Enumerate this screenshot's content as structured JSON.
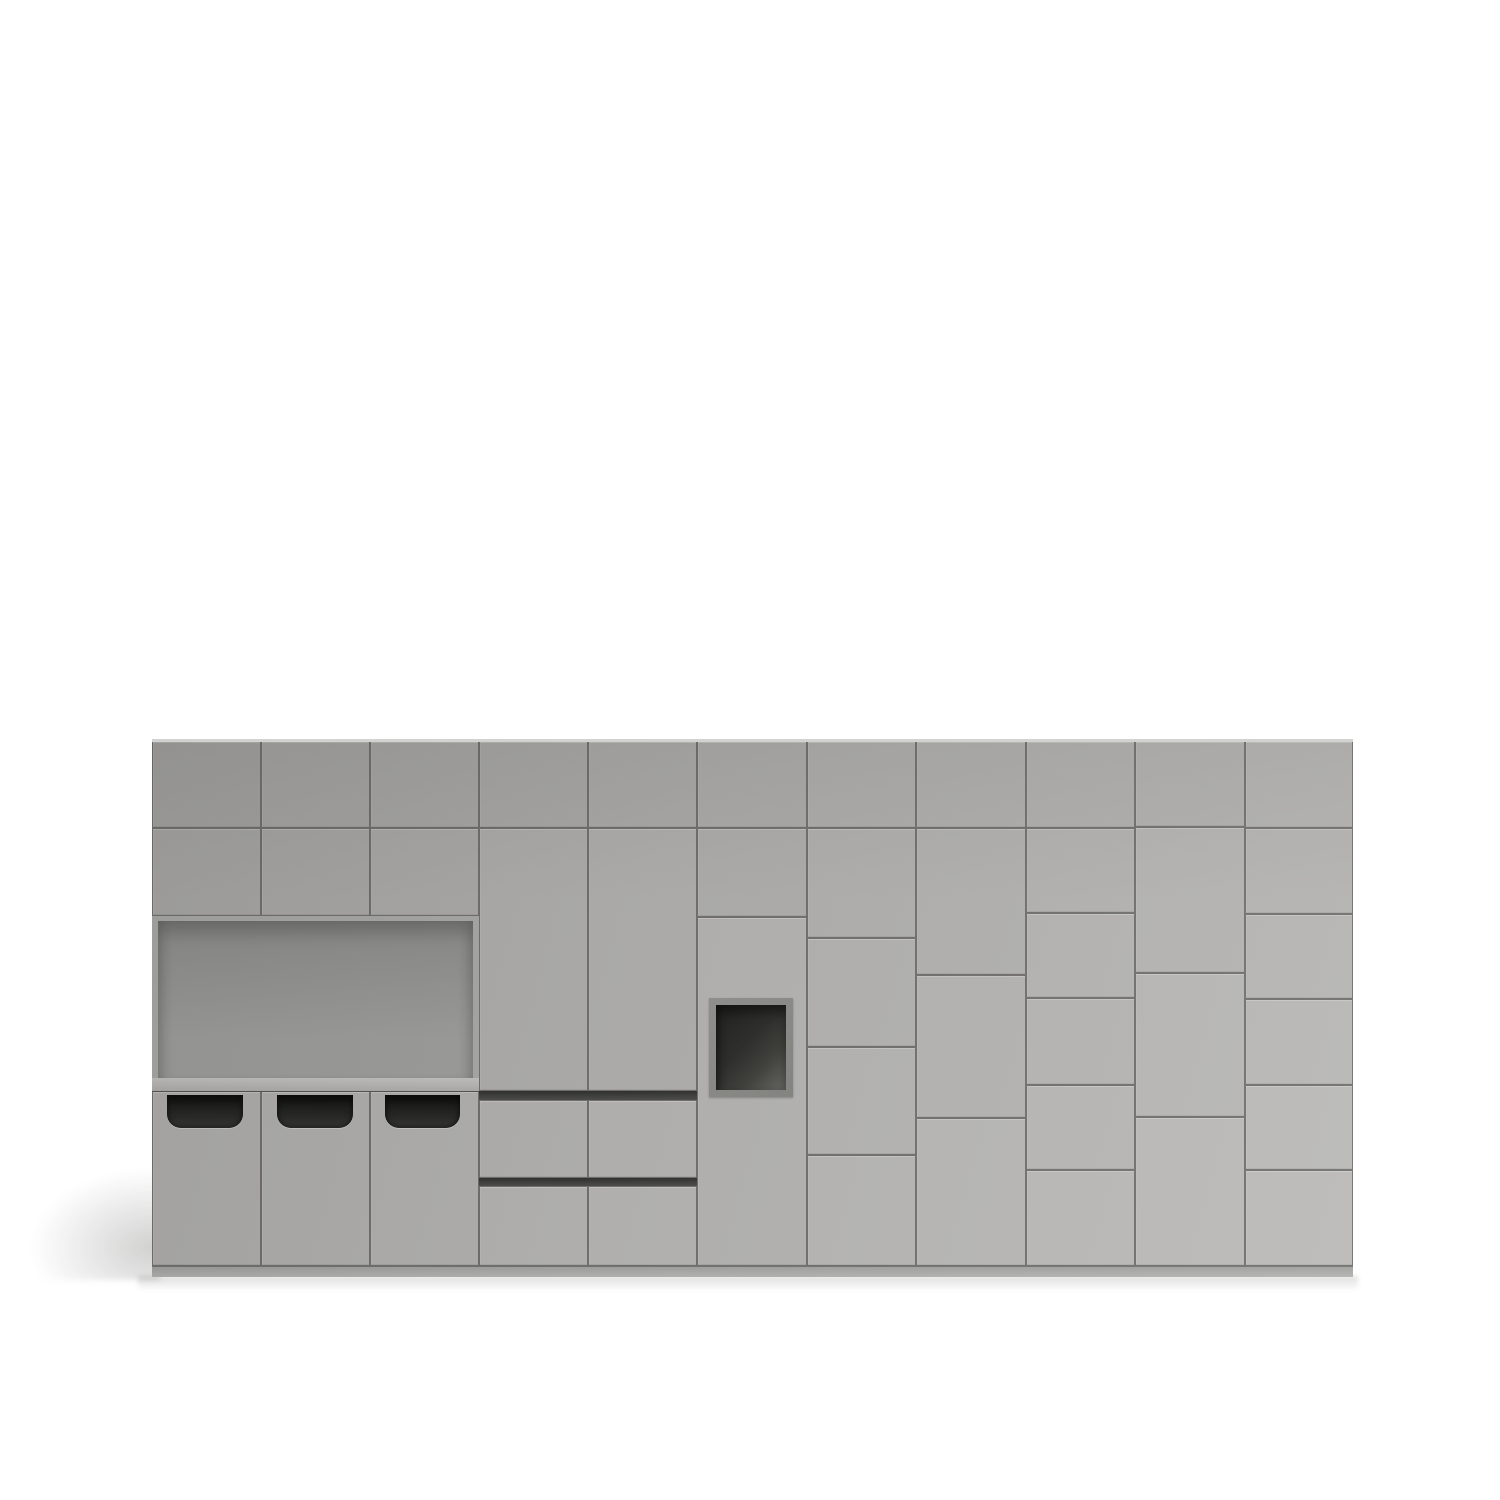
{
  "scene": {
    "description": "3D product render of a light gray modular storage cabinet wall on a white background",
    "canvas": {
      "width": 1500,
      "height": 1500,
      "background": "#ffffff"
    },
    "colors": {
      "face_dark": "#a3a2a0",
      "face_light": "#bbbab8",
      "seam": "#6f6e6c",
      "top_edge": "#d2d2d0",
      "plinth_top": "#9d9d9b",
      "plinth_bottom": "#b1b1af",
      "niche_wall": "#a7a7a5",
      "niche_back_top": "#8a8a88",
      "niche_back_bottom": "#9c9c9a",
      "shelf_top": "#c1c0be",
      "shelf_bottom": "#acabaa",
      "bin_top": "#121210",
      "bin_mid": "#232321",
      "bin_bottom": "#343431",
      "cubby_frame": "#8f8f8d",
      "cubby_dark": "#1f1f1d",
      "cubby_light": "#666662",
      "groove_top": "#30302e",
      "groove_bottom": "#4c4c4a",
      "shadow": "rgba(45,45,43,0.22)"
    },
    "cabinet": {
      "x": 152,
      "y": 741,
      "w": 1201,
      "h": 525
    },
    "top_edge_strip": [
      152,
      739,
      1201,
      3
    ],
    "plinth": [
      152,
      1266,
      1201,
      11
    ],
    "doors": [
      [
        152,
        741,
        109,
        87
      ],
      [
        261,
        741,
        109,
        87
      ],
      [
        370,
        741,
        109,
        87
      ],
      [
        152,
        828,
        109,
        88
      ],
      [
        261,
        828,
        109,
        88
      ],
      [
        370,
        828,
        109,
        88
      ],
      [
        479,
        741,
        109,
        87
      ],
      [
        588,
        741,
        109,
        87
      ],
      [
        479,
        828,
        109,
        263
      ],
      [
        588,
        828,
        109,
        263
      ],
      [
        697,
        741,
        110,
        87
      ],
      [
        697,
        828,
        110,
        89
      ],
      [
        697,
        917,
        110,
        349
      ],
      [
        807,
        741,
        109,
        87
      ],
      [
        807,
        828,
        109,
        110
      ],
      [
        807,
        938,
        109,
        109
      ],
      [
        807,
        1047,
        109,
        108
      ],
      [
        807,
        1155,
        109,
        111
      ],
      [
        916,
        741,
        110,
        87
      ],
      [
        916,
        828,
        110,
        147
      ],
      [
        916,
        975,
        110,
        143
      ],
      [
        916,
        1118,
        110,
        148
      ],
      [
        1026,
        741,
        109,
        87
      ],
      [
        1026,
        828,
        109,
        85
      ],
      [
        1026,
        913,
        109,
        85
      ],
      [
        1026,
        998,
        109,
        87
      ],
      [
        1026,
        1085,
        109,
        85
      ],
      [
        1026,
        1170,
        109,
        96
      ],
      [
        1135,
        741,
        110,
        86
      ],
      [
        1135,
        827,
        110,
        146
      ],
      [
        1135,
        973,
        110,
        144
      ],
      [
        1135,
        1117,
        110,
        149
      ],
      [
        1245,
        741,
        108,
        87
      ],
      [
        1245,
        828,
        108,
        86
      ],
      [
        1245,
        914,
        108,
        85
      ],
      [
        1245,
        999,
        108,
        86
      ],
      [
        1245,
        1085,
        108,
        85
      ],
      [
        1245,
        1170,
        108,
        96
      ]
    ],
    "drawers": [
      [
        479,
        1100,
        109,
        78
      ],
      [
        588,
        1100,
        109,
        78
      ],
      [
        479,
        1186,
        109,
        80
      ],
      [
        588,
        1186,
        109,
        80
      ]
    ],
    "grooves": [
      [
        479,
        1091,
        218,
        9
      ],
      [
        479,
        1178,
        218,
        8
      ]
    ],
    "bin_doors": [
      [
        152,
        1091,
        109,
        175
      ],
      [
        261,
        1091,
        109,
        175
      ],
      [
        370,
        1091,
        109,
        175
      ]
    ],
    "bin_openings": [
      [
        167,
        1095,
        76,
        33
      ],
      [
        277,
        1095,
        76,
        33
      ],
      [
        385,
        1095,
        75,
        33
      ]
    ],
    "niche": {
      "outer": [
        152,
        916,
        327,
        175
      ],
      "inner": [
        158,
        921,
        315,
        157
      ],
      "shelf": [
        152,
        1078,
        327,
        13
      ]
    },
    "cubby": {
      "frame": [
        709,
        998,
        84,
        99
      ],
      "inner": [
        716,
        1005,
        70,
        85
      ]
    },
    "shadows": {
      "left_wedge": [
        25,
        1165,
        135,
        115
      ],
      "bottom_strip": [
        138,
        1276,
        1220,
        15
      ]
    }
  }
}
